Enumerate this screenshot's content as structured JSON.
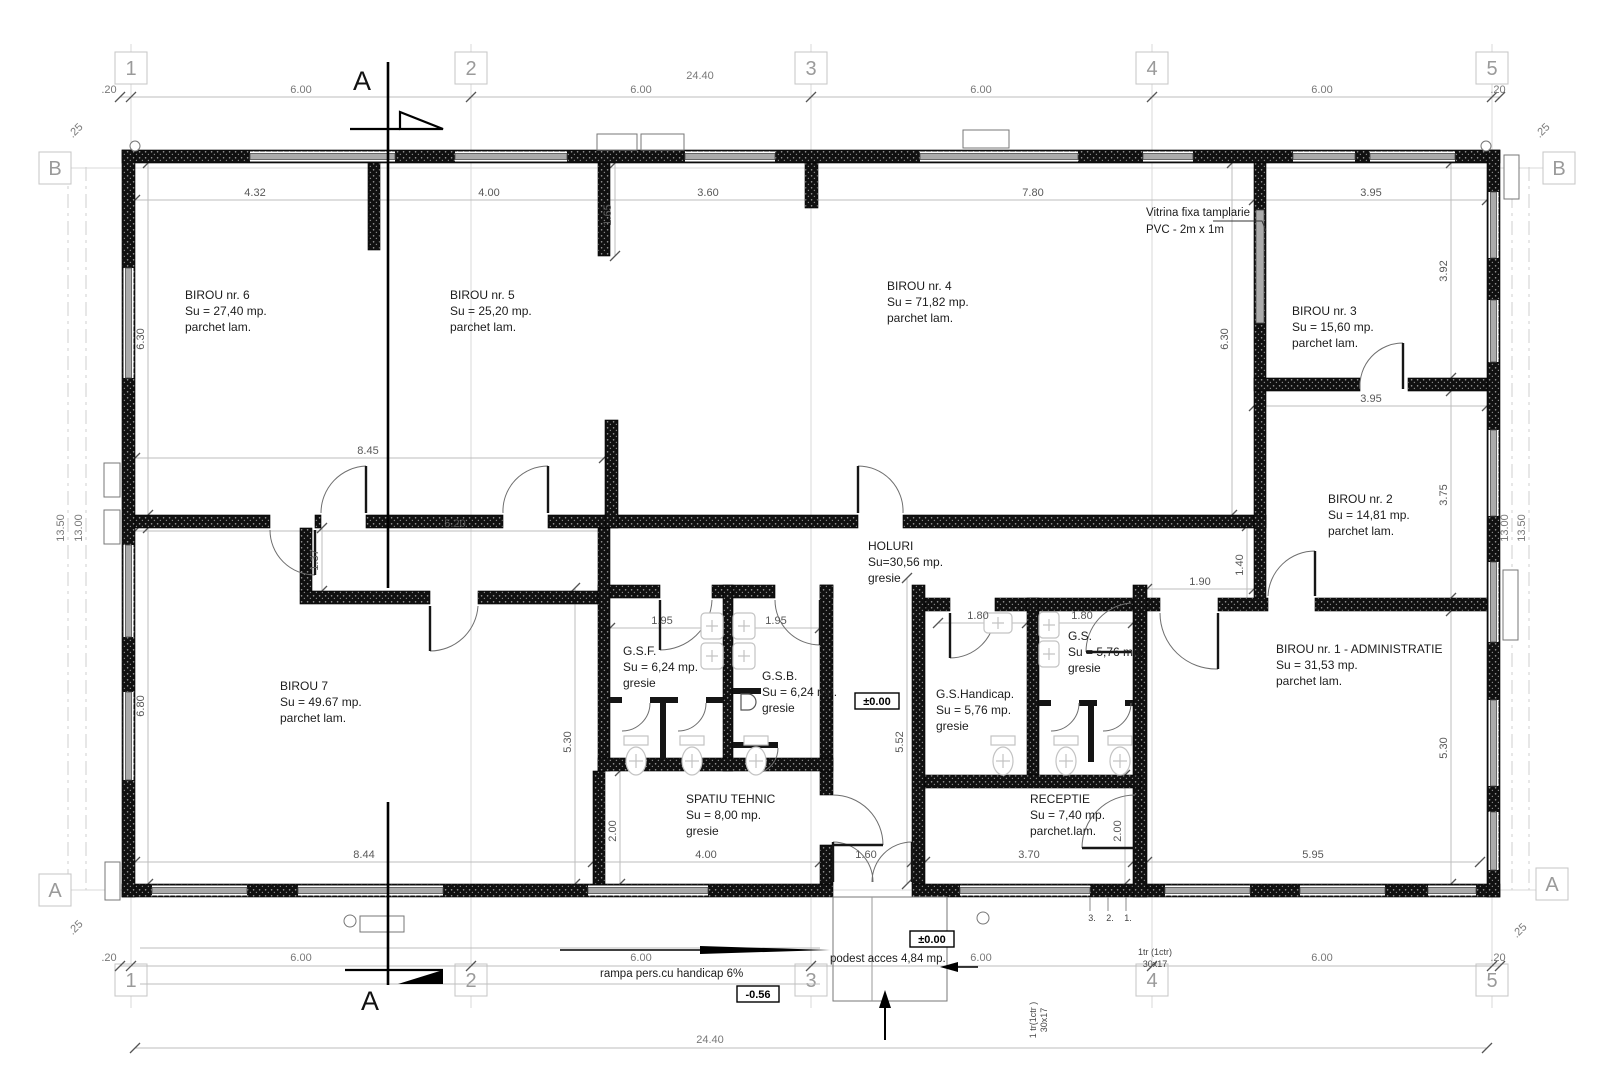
{
  "grid": {
    "cols": [
      "1",
      "2",
      "3",
      "4",
      "5"
    ],
    "rows": [
      "B",
      "A"
    ]
  },
  "section": {
    "label": "A"
  },
  "rooms": [
    {
      "name": "BIROU nr. 6",
      "area": "Su = 27,40 mp.",
      "floor": "parchet lam."
    },
    {
      "name": "BIROU nr. 5",
      "area": "Su = 25,20 mp.",
      "floor": "parchet lam."
    },
    {
      "name": "BIROU nr. 4",
      "area": "Su = 71,82 mp.",
      "floor": "parchet lam."
    },
    {
      "name": "BIROU nr. 3",
      "area": "Su = 15,60 mp.",
      "floor": "parchet lam."
    },
    {
      "name": "BIROU nr. 2",
      "area": "Su = 14,81 mp.",
      "floor": "parchet lam."
    },
    {
      "name": "BIROU nr. 1 - ADMINISTRATIE",
      "area": "Su = 31,53 mp.",
      "floor": "parchet lam."
    },
    {
      "name": "BIROU 7",
      "area": "Su = 49.67 mp.",
      "floor": "parchet lam."
    },
    {
      "name": "HOLURI",
      "area": "Su=30,56 mp.",
      "floor": "gresie"
    },
    {
      "name": "G.S.F.",
      "area": "Su = 6,24 mp.",
      "floor": "gresie"
    },
    {
      "name": "G.S.B.",
      "area": "Su = 6,24 mp.",
      "floor": "gresie"
    },
    {
      "name": "G.S.Handicap.",
      "area": "Su = 5,76 mp.",
      "floor": "gresie"
    },
    {
      "name": "G.S.",
      "area": "Su = 5,76 mp.",
      "floor": "gresie"
    },
    {
      "name": "SPATIU TEHNIC",
      "area": "Su = 8,00 mp.",
      "floor": "gresie"
    },
    {
      "name": "RECEPTIE",
      "area": "Su = 7,40 mp.",
      "floor": "parchet.lam."
    }
  ],
  "dims": {
    "overall": "24.40",
    "bay": "6.00",
    "end": ".20",
    "corner": ".25",
    "d432": "4.32",
    "d400": "4.00",
    "d360": "3.60",
    "d780": "7.80",
    "d395": "3.95",
    "d392": "3.92",
    "d630": "6.30",
    "d680": "6.80",
    "d1300": "13.00",
    "d1350": "13.50",
    "d375": "3.75",
    "d140": "1.40",
    "d530": "5.30",
    "d595": "5.95",
    "d845": "8.45",
    "d844": "8.44",
    "d520": "5.20",
    "d137": "1.37",
    "d165": "1.65",
    "d195": "1.95",
    "d552": "5.52",
    "d180": "1.80",
    "d190": "1.90",
    "d200": "2.00",
    "d370": "3.70",
    "d160": "1.60"
  },
  "levels": {
    "zero": "±0.00",
    "below": "-0.56"
  },
  "annotations": {
    "vitrina_l1": "Vitrina fixa tamplarie",
    "vitrina_l2": "PVC - 2m x 1m",
    "ramp": "rampa pers.cu handicap 6%",
    "podest": "podest acces 4,84 mp.",
    "stair_l1": "1tr (1ctr)",
    "stair_l2": "30x17",
    "stair_v1": "1 tr(1ctr )",
    "stair_v2": "30x17",
    "steps": [
      "3.",
      "2.",
      "1."
    ]
  }
}
